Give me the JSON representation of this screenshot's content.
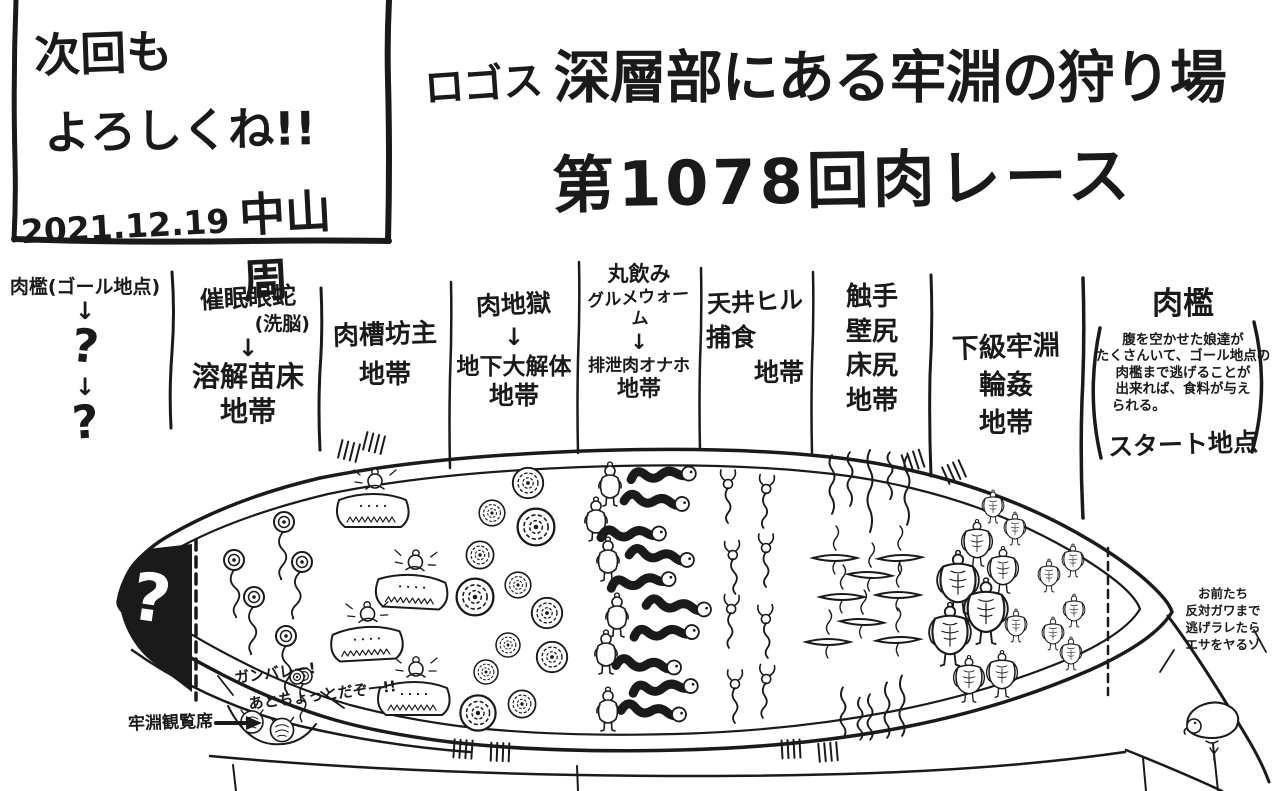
{
  "corner_note": {
    "line1": "次回も",
    "line2": "よろしくね!!",
    "date": "2021.12.19",
    "author": "中山 周"
  },
  "title": {
    "small": "ロゴス",
    "line1": "深層部にある牢淵の狩り場",
    "line2": "第1078回肉レース"
  },
  "glyphs": {
    "down_arrow": "↓"
  },
  "zones": {
    "goal": {
      "lines": [
        "肉檻(ゴール地点)",
        "↓",
        "?",
        "↓",
        "?"
      ]
    },
    "hypno": {
      "lines": [
        "催眠眼蛇",
        "(洗脳)",
        "↓",
        "溶解苗床",
        "地帯"
      ]
    },
    "tub": {
      "lines": [
        "肉槽坊主",
        "地帯"
      ]
    },
    "hell": {
      "lines": [
        "肉地獄",
        "↓",
        "地下大解体",
        "地帯"
      ]
    },
    "worm": {
      "lines": [
        "丸飲み",
        "グルメウォーム",
        "↓",
        "排泄肉オナホ",
        "地帯"
      ]
    },
    "leech": {
      "lines": [
        "天井ヒル",
        "捕食",
        "地帯"
      ]
    },
    "tentacle": {
      "lines": [
        "触手",
        "壁尻",
        "床尻",
        "地帯"
      ]
    },
    "prison": {
      "lines": [
        "下級牢淵",
        "輪姦",
        "地帯"
      ]
    },
    "start": {
      "heading": "肉檻",
      "desc": [
        "腹を空かせた娘達が",
        "たくさんいて、ゴール地点の",
        "肉檻まで逃げることが",
        "出来れば、食料が与え",
        "られる。"
      ],
      "label": "スタート地点"
    }
  },
  "map": {
    "goal_mark": "?",
    "spectator_label": "牢淵観覧席",
    "cheer": [
      "ガンバレー!",
      "あとちょっとだぞー!!"
    ],
    "seal_speech": [
      "お前たち",
      "反対ガワまで",
      "逃げラレたら",
      "エサをヤるゾ"
    ]
  },
  "colors": {
    "ink": "#1a1a1a",
    "paper": "#ffffff"
  }
}
